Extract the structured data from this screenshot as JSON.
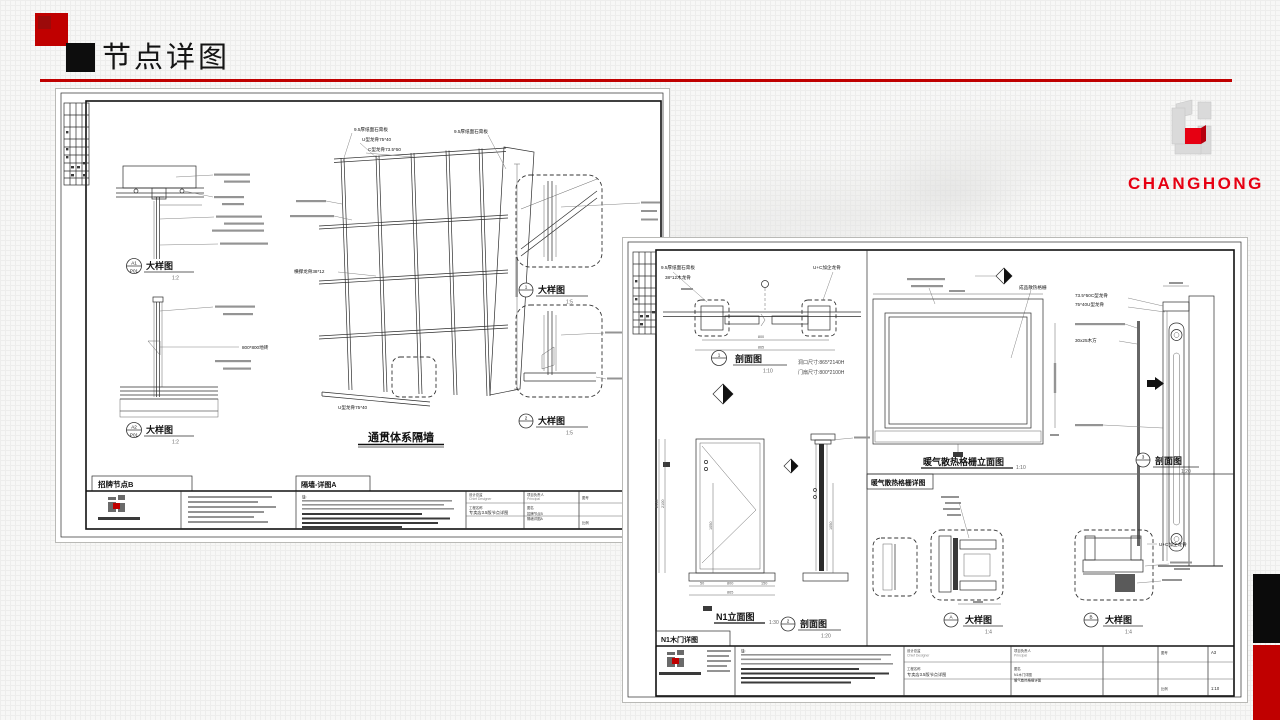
{
  "slide": {
    "title": "节点详图"
  },
  "brand": {
    "wordmark": "CHANGHONG"
  },
  "sheet1": {
    "tab_left": "招牌节点B",
    "tab_right": "隔墙-详图A",
    "main_title": "通贯体系隔墙",
    "det_a1": {
      "id": "A1",
      "sub": "P01",
      "label": "大样图",
      "scale": "1:2"
    },
    "det_a2": {
      "id": "A2",
      "sub": "P01",
      "label": "大样图",
      "scale": "1:2"
    },
    "det_1": {
      "id": "1",
      "label": "大样图",
      "scale": "1:5"
    },
    "det_2": {
      "id": "2",
      "label": "大样图",
      "scale": "1:5"
    },
    "ann": {
      "board_top": "9.5厚纸面石膏板",
      "u_runner": "U型龙骨75*40",
      "c_stud": "C型龙骨73.5*50",
      "board_right": "9.5厚纸面石膏板",
      "cross_stud": "横撑龙骨38*12",
      "u_bottom": "U型龙骨75*40",
      "tile": "800*800地砖"
    },
    "tb": {
      "note": "注:",
      "project": "专卖店3.5版节点详图",
      "name1": "招牌节点B",
      "name2": "隔墙详图A",
      "size": "A3",
      "scale": "1:40"
    }
  },
  "sheet2": {
    "tab_grille": "暖气散热格栅详图",
    "tab_door": "N1木门详图",
    "sec1": {
      "id": "1",
      "label": "剖面图",
      "scale": "1:10"
    },
    "sec2": {
      "id": "2",
      "label": "剖面图",
      "scale": "1:20"
    },
    "sec3": {
      "id": "3",
      "label": "剖面图",
      "scale": "1:20"
    },
    "det_a": {
      "id": "A",
      "label": "大样图",
      "scale": "1:4"
    },
    "det_b": {
      "id": "B",
      "label": "大样图",
      "scale": "1:4"
    },
    "elev_door": {
      "label": "N1立面图",
      "scale": "1:30"
    },
    "elev_grille": {
      "label": "暖气散热格栅立面图",
      "scale": "1:10"
    },
    "opening_size": "洞口尺寸:865*2140H",
    "leaf_size": "门扇尺寸:800*2100H",
    "ann": {
      "board": "9.5厚纸面石膏板",
      "wood_stud": "38*12木龙骨",
      "uc_stud_top": "U+C加企龙骨",
      "uc_stud_b": "U+C加企龙骨",
      "c_stud": "73.5*50C型龙骨",
      "u_runner": "75*40U型龙骨",
      "louver": "成品散热格栅",
      "wood_block": "30x25木方"
    },
    "dims": {
      "w865": "865",
      "w800": "800",
      "w150": "150",
      "w50": "50",
      "h2140": "2140",
      "h2100": "2100",
      "h1050": "1050"
    },
    "tb": {
      "note": "注:",
      "project": "专卖店3.5版节点详图",
      "name1": "N1木门详图",
      "name2": "暖气散热格栅详图",
      "size": "A3",
      "scale": "1:10"
    }
  },
  "tb_labels": {
    "designer": "设计总监",
    "designer_en": "Chief Designer",
    "principal": "项目负责人",
    "principal_en": "Principal",
    "project": "工程名称",
    "name": "图名",
    "scale": "比例",
    "no": "图号"
  }
}
